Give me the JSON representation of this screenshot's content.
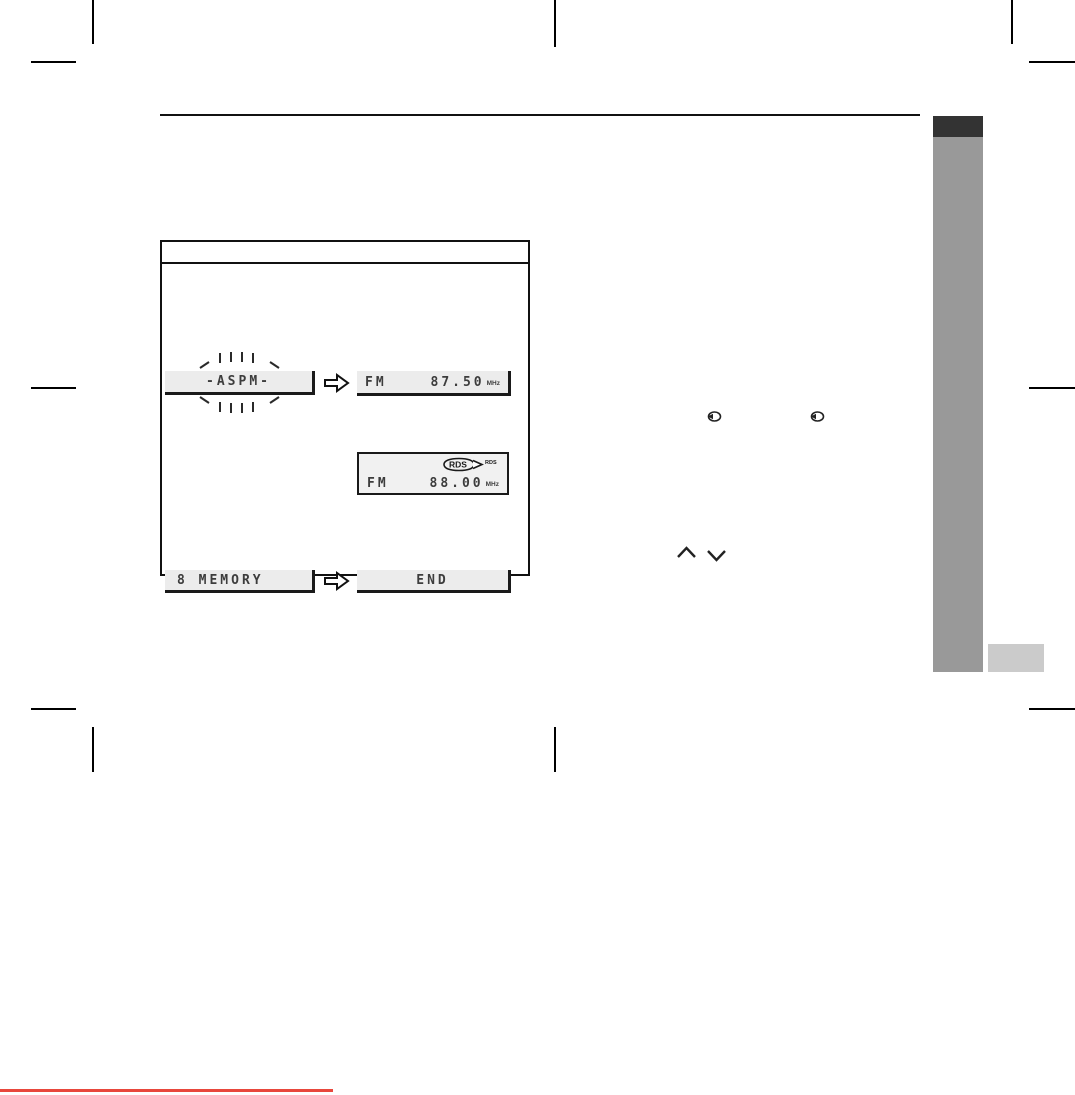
{
  "document": {
    "kind": "scanned-manual-page"
  },
  "lcd": {
    "aspm": "-ASPM-",
    "fm1_band": "FM",
    "fm1_freq": "87.50",
    "fm1_unit": "MHz",
    "rds_badge": "RDS",
    "rds_caption": "RDS",
    "fm2_band": "FM",
    "fm2_freq": "88.00",
    "fm2_unit": "MHz",
    "memory": "8 MEMORY",
    "end": "END"
  },
  "icons": {
    "step_arrow": "outline-right-arrow",
    "blink_indicator": "blink-rays",
    "rds_badge": "rds-oval-badge",
    "jog_button_1": "jog-dial-button",
    "jog_button_2": "jog-dial-button",
    "tune_up": "chevron-up",
    "tune_down": "chevron-down"
  },
  "colors": {
    "sidebar_tab": "#333333",
    "sidebar_band": "#999999",
    "sidebar_chip": "#cbcbcb",
    "footer_rule": "#e8473c",
    "lcd_background": "#ececec",
    "lcd_text": "#3d3d3d"
  }
}
